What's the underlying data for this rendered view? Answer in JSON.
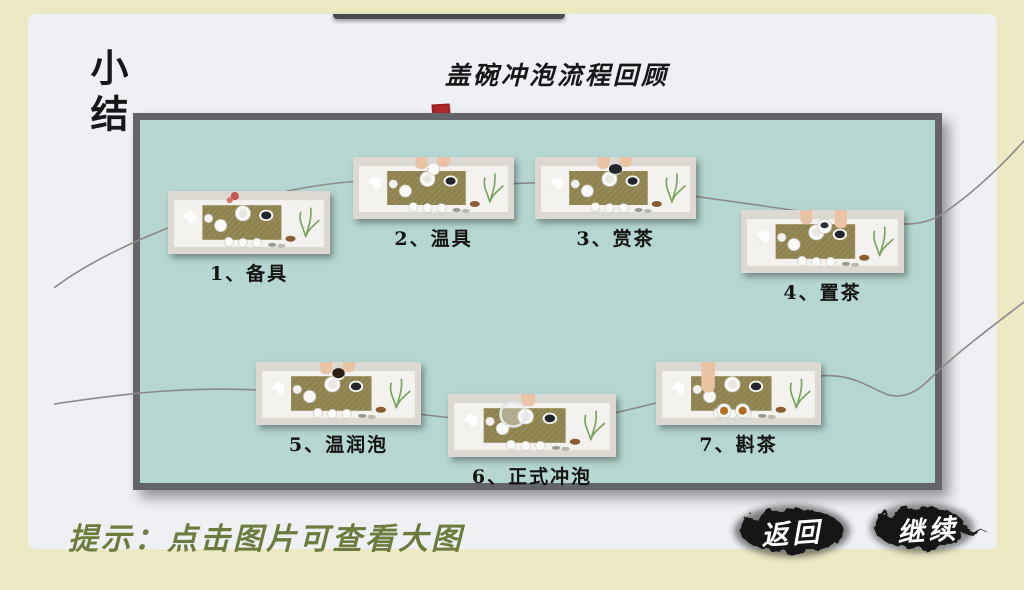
{
  "page": {
    "side_title": "小结",
    "title": "盖碗冲泡流程回顾",
    "tip": "提示：点击图片可查看大图",
    "colors": {
      "background_cream": "#ede9c5",
      "card_gray": "#eef0f4",
      "board_teal": "#b5d6d1",
      "board_border": "#63636a",
      "seal_red": "#b3282a",
      "tip_green": "#6d7c3c",
      "ink_black": "#161616",
      "flow_line_gray": "#8a8a8a"
    },
    "icons": {
      "seal": "red-seal-icon",
      "flow_lines": "flow-connector-lines"
    }
  },
  "steps": [
    {
      "num": "1",
      "label": "1、备具"
    },
    {
      "num": "2",
      "label": "2、温具"
    },
    {
      "num": "3",
      "label": "3、赏茶"
    },
    {
      "num": "4",
      "label": "4、置茶"
    },
    {
      "num": "5",
      "label": "5、温润泡"
    },
    {
      "num": "6",
      "label": "6、正式冲泡"
    },
    {
      "num": "7",
      "label": "7、斟茶"
    }
  ],
  "buttons": {
    "back": "返回",
    "continue": "继续"
  }
}
